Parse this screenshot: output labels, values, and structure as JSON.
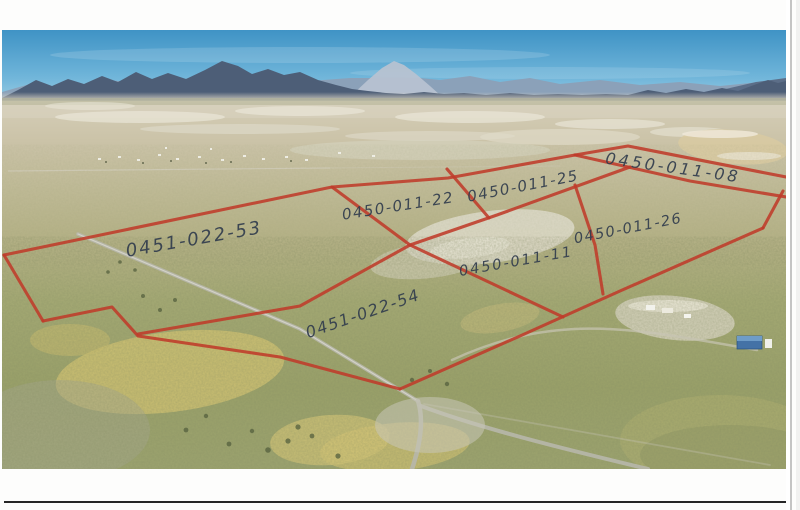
{
  "overlay": {
    "annotation_color": "#bf3b2a",
    "ink_color": "#333e4e",
    "parcels": [
      {
        "label": "0451-022-53"
      },
      {
        "label": "0450-011-22"
      },
      {
        "label": "0450-011-25"
      },
      {
        "label": "0450-011-08"
      },
      {
        "label": "0450-011-26"
      },
      {
        "label": "0450-011-11"
      },
      {
        "label": "0451-022-54"
      }
    ],
    "boundary_lines": [
      {
        "name": "plat-northwest-boundary",
        "points": "4,255 332,187 448,178 575,155"
      },
      {
        "name": "plat-north-boundary",
        "points": "575,155 628,146 786,177"
      },
      {
        "name": "divider-08-26",
        "points": "575,155 690,181 786,197"
      },
      {
        "name": "plat-west-edge",
        "points": "4,255 43,321"
      },
      {
        "name": "parcel-54-southwest-boundary",
        "points": "43,321 112,307 138,336 280,357 400,389"
      },
      {
        "name": "row-divider-53-54",
        "points": "138,334 300,306 410,245 497,215 630,167"
      },
      {
        "name": "divider-left-right-group",
        "points": "332,187 410,245 563,317"
      },
      {
        "name": "plat-south-boundary",
        "points": "400,389 520,336 620,291 763,228"
      },
      {
        "name": "parcel-26-east-edge",
        "points": "763,228 783,191"
      },
      {
        "name": "divider-22-25",
        "points": "447,169 489,218"
      },
      {
        "name": "divider-11-26",
        "points": "575,185 595,245 603,294"
      }
    ]
  }
}
